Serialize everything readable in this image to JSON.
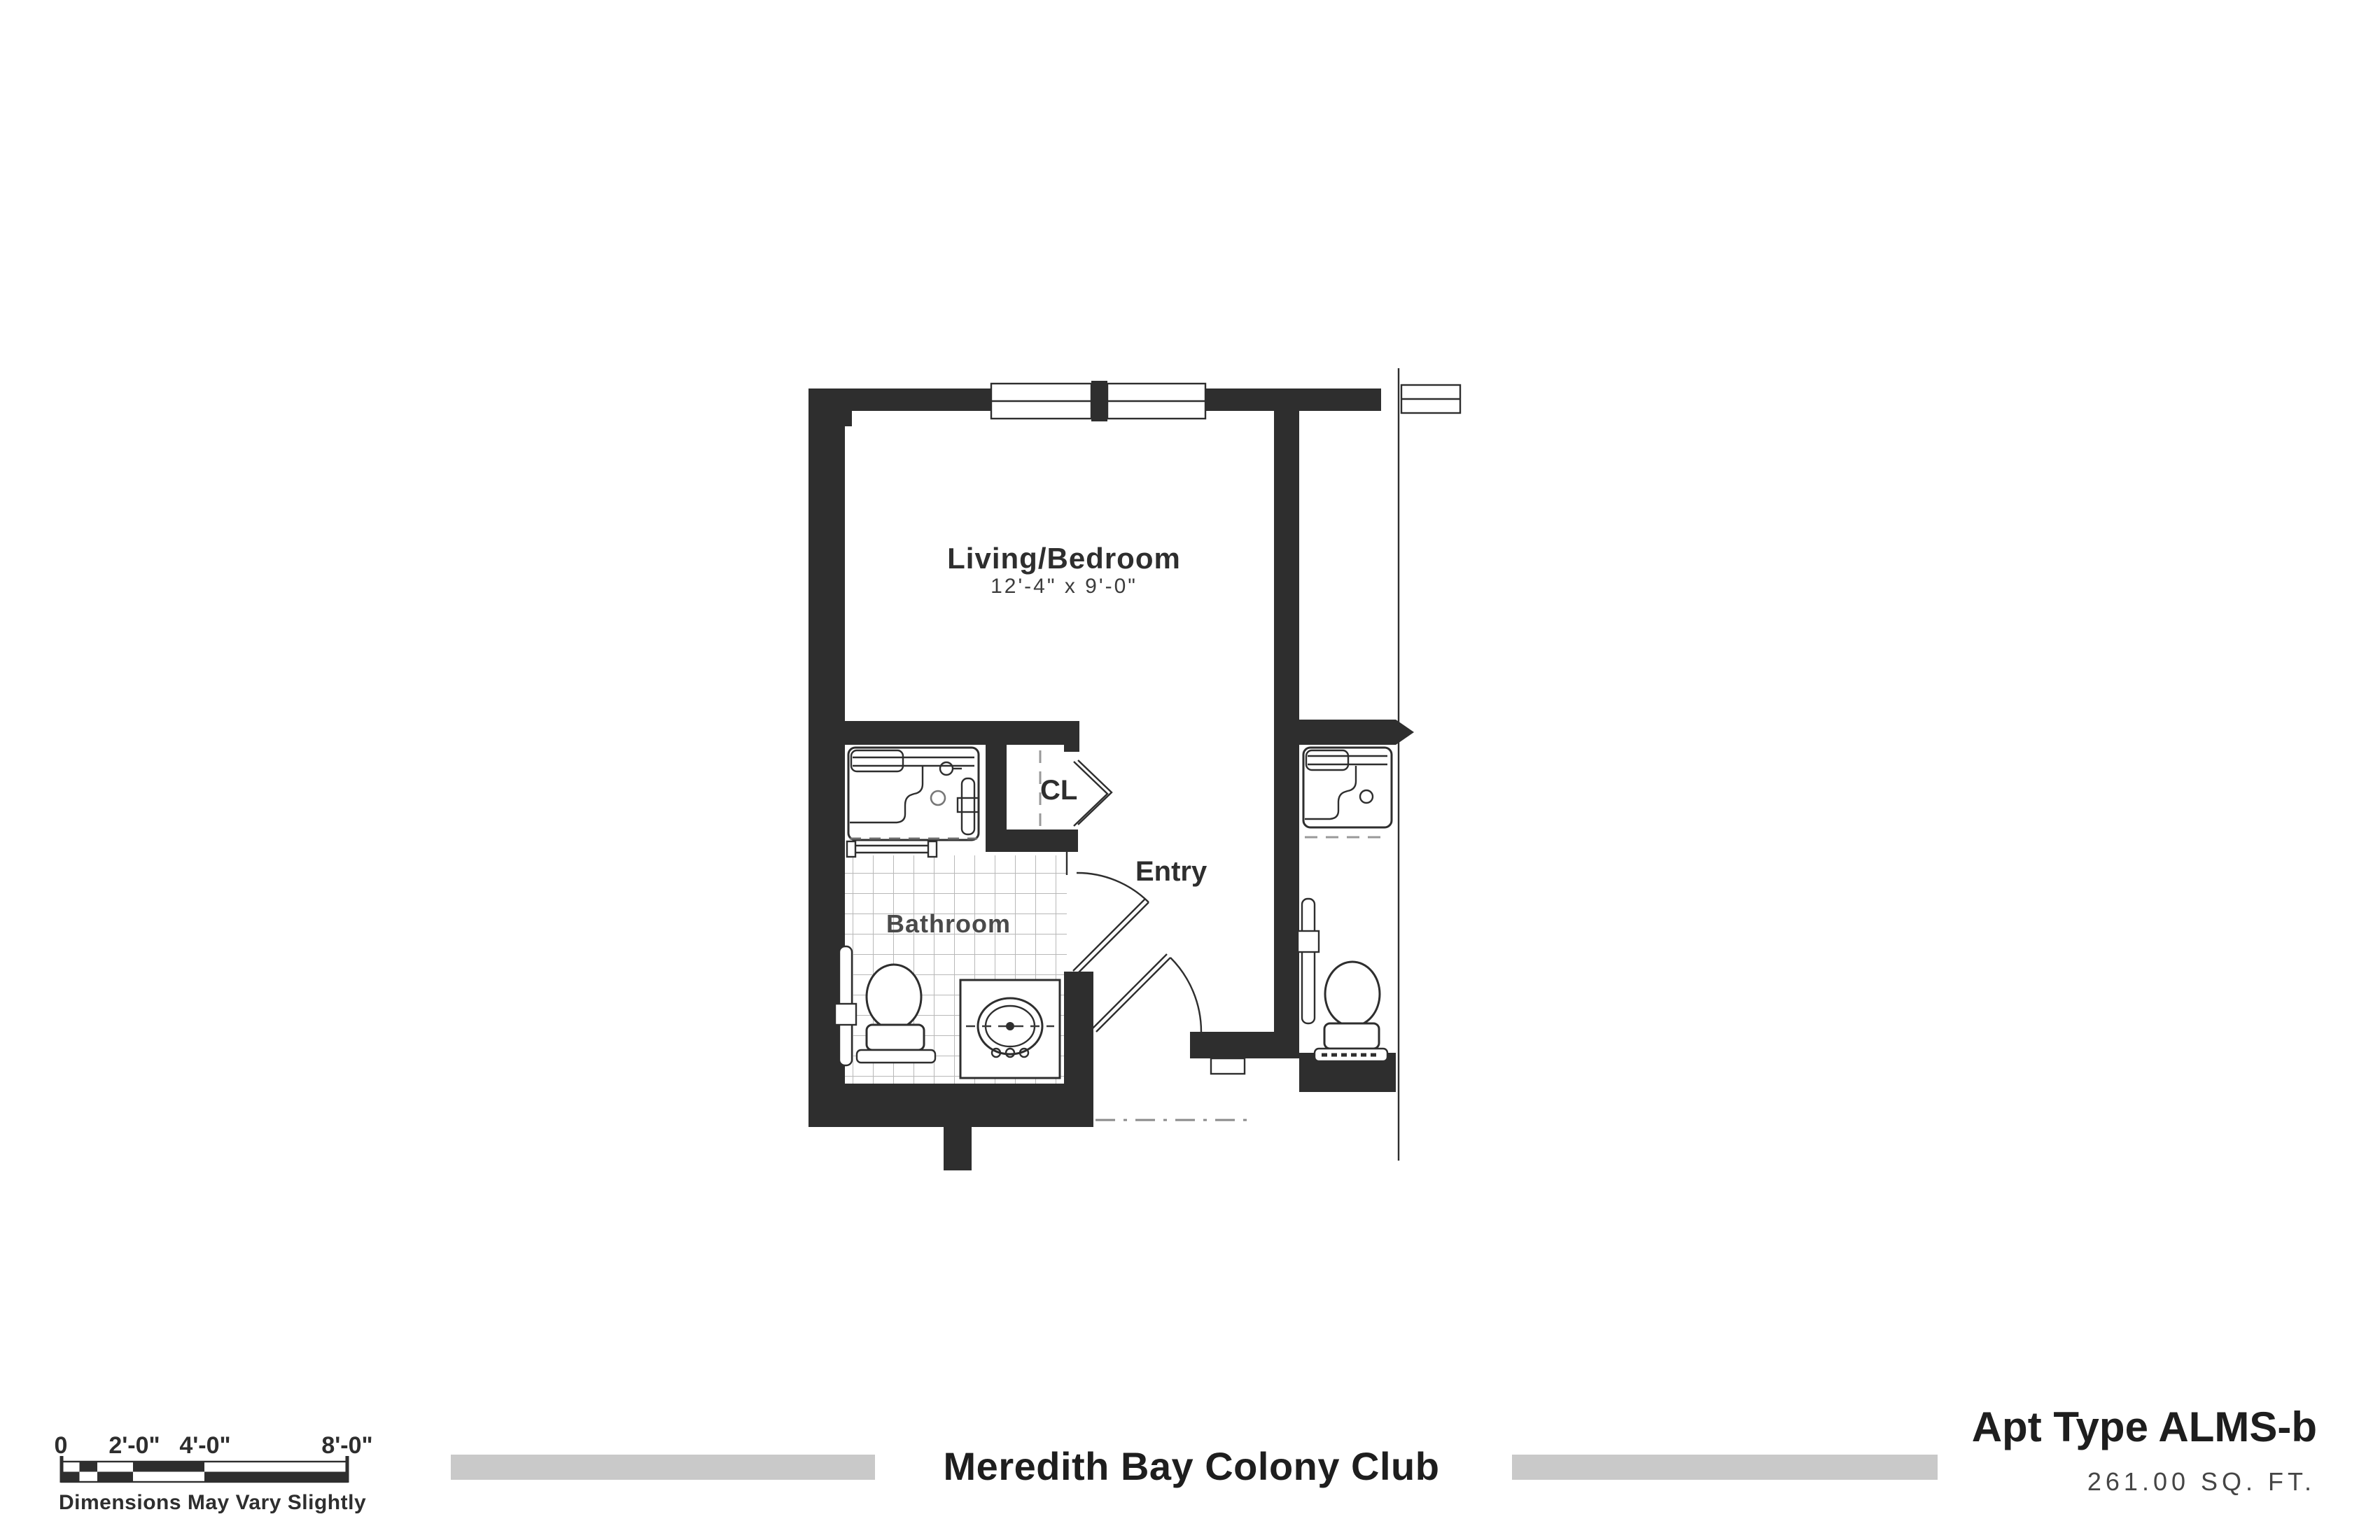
{
  "plan": {
    "living": {
      "label": "Living/Bedroom",
      "dims": "12'-4\" x 9'-0\""
    },
    "closet_label": "CL",
    "entry_label": "Entry",
    "bathroom_label": "Bathroom"
  },
  "scale_bar": {
    "labels": [
      "0",
      "2'-0\"",
      "4'-0\"",
      "8'-0\""
    ],
    "disclaimer": "Dimensions May Vary Slightly"
  },
  "footer": {
    "project_title": "Meredith Bay Colony Club",
    "apt_type": "Apt Type ALMS-b",
    "area": "261.00 SQ. FT."
  },
  "colors": {
    "ink": "#2e2e2e",
    "tile": "#b8b8b8",
    "bar": "#c9c9c9",
    "dash": "#999999"
  }
}
